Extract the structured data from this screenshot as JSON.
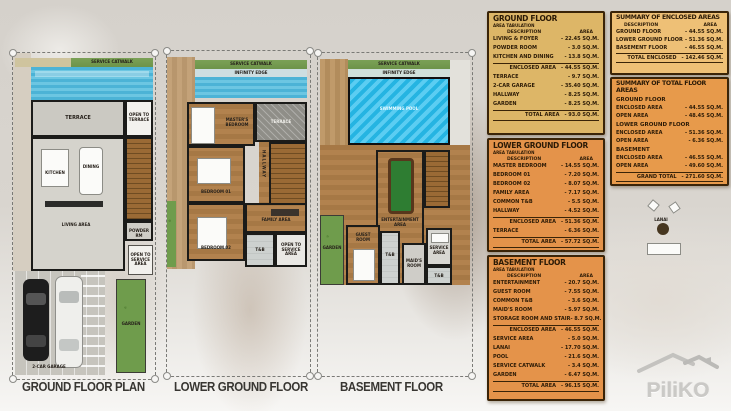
{
  "plans": [
    {
      "label": "GROUND FLOOR PLAN",
      "rooms": {
        "service_catwalk": "SERVICE CATWALK",
        "terrace": "TERRACE",
        "open_to_terrace": "OPEN TO TERRACE",
        "kitchen": "KITCHEN",
        "dining": "DINING",
        "living": "LIVING AREA",
        "powder": "POWDER RM",
        "open_to_service": "OPEN TO SERVICE AREA",
        "garden": "GARDEN",
        "garage": "2-CAR GARAGE"
      }
    },
    {
      "label": "LOWER GROUND FLOOR",
      "rooms": {
        "service_catwalk": "SERVICE CATWALK",
        "infinity_edge": "INFINITY EDGE",
        "master_bedroom": "MASTER'S BEDROOM",
        "terrace": "TERRACE",
        "hallway": "HALLWAY",
        "bedroom1": "BEDROOM 01",
        "bedroom2": "BEDROOM 02",
        "family": "FAMILY AREA",
        "tb": "T&B",
        "open_to_service": "OPEN TO SERVICE AREA"
      }
    },
    {
      "label": "BASEMENT FLOOR",
      "rooms": {
        "service_catwalk": "SERVICE CATWALK",
        "infinity_edge": "INFINITY EDGE",
        "pool": "SWIMMING POOL",
        "lanai": "LANAI",
        "entertainment": "ENTERTAINMENT AREA",
        "garden": "GARDEN",
        "guest": "GUEST ROOM",
        "tb1": "T&B",
        "maids": "MAID'S ROOM",
        "service_area": "SERVICE AREA",
        "tb2": "T&B"
      }
    }
  ],
  "tables": [
    {
      "title": "GROUND FLOOR",
      "subtitle": "AREA TABULATION",
      "headers": {
        "desc": "DESCRIPTION",
        "area": "AREA"
      },
      "rows": [
        {
          "t": "i",
          "d": "LIVING & FOYER",
          "a": "22.45 SQ.M."
        },
        {
          "t": "i",
          "d": "POWDER ROOM",
          "a": "3.0 SQ.M."
        },
        {
          "t": "i",
          "d": "KITCHEN AND DINING",
          "a": "13.8 SQ.M."
        },
        {
          "t": "s",
          "d": "ENCLOSED AREA",
          "a": "44.55 SQ.M."
        },
        {
          "t": "i",
          "d": "TERRACE",
          "a": "9.7 SQ.M."
        },
        {
          "t": "i",
          "d": "2-CAR GARAGE",
          "a": "35.40 SQ.M."
        },
        {
          "t": "i",
          "d": "HALLWAY",
          "a": "8.25 SQ.M."
        },
        {
          "t": "i",
          "d": "GARDEN",
          "a": "8.25 SQ.M."
        },
        {
          "t": "T",
          "d": "TOTAL AREA",
          "a": "93.0 SQ.M."
        }
      ]
    },
    {
      "title": "LOWER GROUND FLOOR",
      "subtitle": "AREA TABULATION",
      "headers": {
        "desc": "DESCRIPTION",
        "area": "AREA"
      },
      "rows": [
        {
          "t": "i",
          "d": "MASTER BEDROOM",
          "a": "14.55 SQ.M."
        },
        {
          "t": "i",
          "d": "BEDROOM 01",
          "a": "7.20 SQ.M."
        },
        {
          "t": "i",
          "d": "BEDROOM 02",
          "a": "8.07 SQ.M."
        },
        {
          "t": "i",
          "d": "FAMILY AREA",
          "a": "7.17 SQ.M."
        },
        {
          "t": "i",
          "d": "COMMON T&B",
          "a": "5.5 SQ.M."
        },
        {
          "t": "i",
          "d": "HALLWAY",
          "a": "4.52 SQ.M."
        },
        {
          "t": "s",
          "d": "ENCLOSED AREA",
          "a": "51.36 SQ.M."
        },
        {
          "t": "i",
          "d": "TERRACE",
          "a": "6.36 SQ.M."
        },
        {
          "t": "T",
          "d": "TOTAL AREA",
          "a": "57.72 SQ.M."
        }
      ]
    },
    {
      "title": "BASEMENT FLOOR",
      "subtitle": "AREA TABULATION",
      "headers": {
        "desc": "DESCRIPTION",
        "area": "AREA"
      },
      "rows": [
        {
          "t": "i",
          "d": "ENTERTAINMENT",
          "a": "20.7 SQ.M."
        },
        {
          "t": "i",
          "d": "GUEST ROOM",
          "a": "7.55 SQ.M."
        },
        {
          "t": "i",
          "d": "COMMON T&B",
          "a": "3.6 SQ.M."
        },
        {
          "t": "i",
          "d": "MAID'S ROOM",
          "a": "5.97 SQ.M."
        },
        {
          "t": "i",
          "d": "STORAGE ROOM AND STAIR",
          "a": "8.7 SQ.M."
        },
        {
          "t": "s",
          "d": "ENCLOSED AREA",
          "a": "46.55 SQ.M."
        },
        {
          "t": "i",
          "d": "SERVICE AREA",
          "a": "5.0 SQ.M."
        },
        {
          "t": "i",
          "d": "LANAI",
          "a": "17.70 SQ.M."
        },
        {
          "t": "i",
          "d": "POOL",
          "a": "21.6 SQ.M."
        },
        {
          "t": "i",
          "d": "SERVICE CATWALK",
          "a": "3.4 SQ.M."
        },
        {
          "t": "i",
          "d": "GARDEN",
          "a": "6.47 SQ.M."
        },
        {
          "t": "T",
          "d": "TOTAL AREA",
          "a": "96.15 SQ.M."
        }
      ]
    }
  ],
  "summary": {
    "enclosed": {
      "title": "SUMMARY OF ENCLOSED AREAS",
      "headers": {
        "desc": "DESCRIPTION",
        "area": "AREA"
      },
      "rows": [
        {
          "t": "i",
          "d": "GROUND FLOOR",
          "a": "44.55 SQ.M."
        },
        {
          "t": "i",
          "d": "LOWER GROUND FLOOR",
          "a": "51.36 SQ.M."
        },
        {
          "t": "i",
          "d": "BASEMENT FLOOR",
          "a": "46.55 SQ.M."
        },
        {
          "t": "T",
          "d": "TOTAL ENCLOSED",
          "a": "142.46 SQ.M."
        }
      ]
    },
    "total_floor": {
      "title": "SUMMARY OF TOTAL FLOOR AREAS",
      "groups": [
        {
          "name": "GROUND FLOOR",
          "rows": [
            {
              "t": "i",
              "d": "ENCLOSED AREA",
              "a": "44.55 SQ.M."
            },
            {
              "t": "i",
              "d": "OPEN AREA",
              "a": "48.45 SQ.M."
            }
          ]
        },
        {
          "name": "LOWER GROUND FLOOR",
          "rows": [
            {
              "t": "i",
              "d": "ENCLOSED AREA",
              "a": "51.36 SQ.M."
            },
            {
              "t": "i",
              "d": "OPEN AREA",
              "a": "6.36 SQ.M."
            }
          ]
        },
        {
          "name": "BASEMENT",
          "rows": [
            {
              "t": "i",
              "d": "ENCLOSED AREA",
              "a": "46.55 SQ.M."
            },
            {
              "t": "i",
              "d": "OPEN AREA",
              "a": "49.60 SQ.M."
            }
          ]
        }
      ],
      "grand": [
        {
          "t": "T",
          "d": "GRAND TOTAL",
          "a": "271.60 SQ.M."
        }
      ]
    }
  },
  "watermark": {
    "brand": "PiliKO"
  },
  "colors": {
    "table_tan": "#ddb667",
    "table_orange": "#e4934a",
    "summary_light": "#eec076",
    "summary_orange": "#e79a4b",
    "pool_blue": "#3db6dd",
    "garden_green": "#6f9c4c",
    "wood_brown": "#b2824e",
    "stair_brown": "#9a6a35"
  }
}
